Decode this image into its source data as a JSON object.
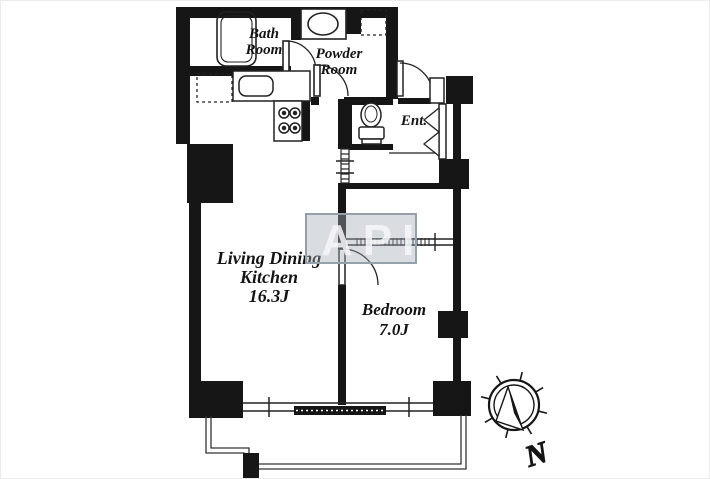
{
  "title": "apartment-floor-plan",
  "colors": {
    "wall": "#161616",
    "line": "#222222",
    "watermark_border": "#96a0ab",
    "watermark_fill": "rgba(165,175,186,0.42)",
    "watermark_text": "#f4f7fa"
  },
  "rooms": {
    "bath": {
      "line1": "Bath",
      "line2": "Room"
    },
    "powder": {
      "line1": "Powder",
      "line2": "Room"
    },
    "entrance": {
      "label": "Ent."
    },
    "ldk": {
      "line1": "Living Dining",
      "line2": "Kitchen",
      "size": "16.3J"
    },
    "bedroom": {
      "line1": "Bedroom",
      "size": "7.0J"
    }
  },
  "compass": {
    "label": "N"
  },
  "watermark": {
    "text": "API"
  }
}
